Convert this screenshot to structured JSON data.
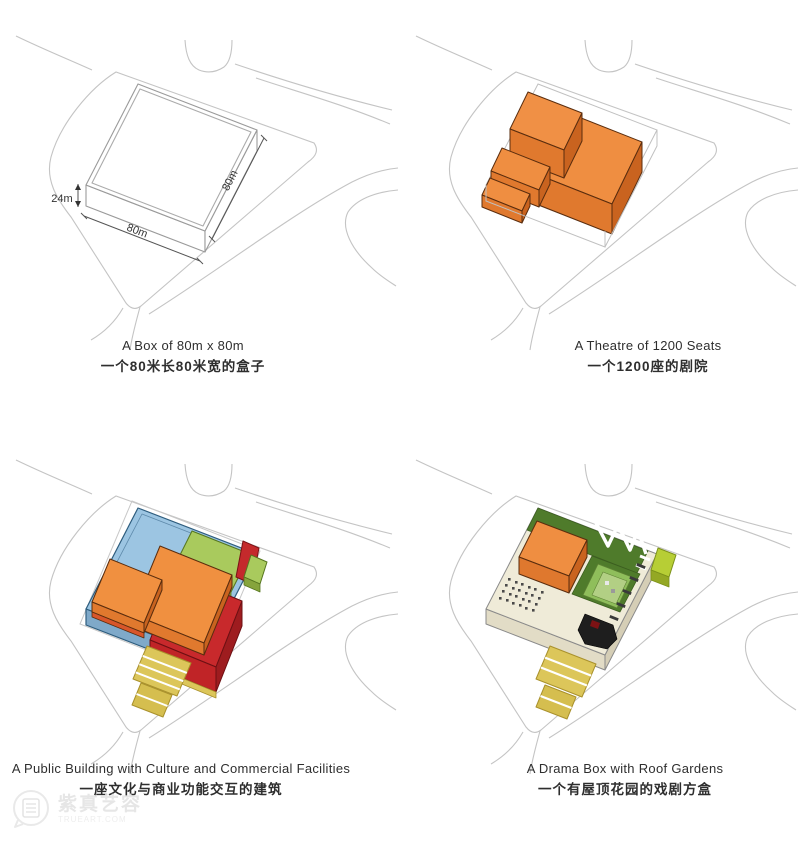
{
  "panels": [
    {
      "id": "box",
      "caption_en": "A Box of  80m x  80m",
      "caption_zh": "一个80米长80米宽的盒子",
      "dims": {
        "height": "24m",
        "width": "80m",
        "depth": "80m"
      }
    },
    {
      "id": "theatre",
      "caption_en": "A Theatre of 1200 Seats",
      "caption_zh": "一个1200座的剧院"
    },
    {
      "id": "public-building",
      "caption_en": "A Public Building with Culture and Commercial Facilities",
      "caption_zh": "一座文化与商业功能交互的建筑"
    },
    {
      "id": "drama-box",
      "caption_en": "A  Drama Box with Roof Gardens",
      "caption_zh": "一个有屋顶花园的戏剧方盒"
    }
  ],
  "watermark": {
    "name": "紫真艺容",
    "site": "TRUEART.COM"
  },
  "colors": {
    "orange_top": "#EF8E41",
    "orange_front": "#E0792E",
    "orange_side": "#C9631F",
    "blue_top": "#9CC5E2",
    "blue_front": "#7FA9C9",
    "red_block": "#C8292C",
    "green_slab": "#A9CA5D",
    "roof_green_dark": "#4F7B2B",
    "roof_green_light": "#8FBE5B",
    "lime_bar": "#B7CE35",
    "stair_yellow": "#DCC65A",
    "deck_cream": "#EFEBD8",
    "site_line": "#C4C4C4"
  }
}
